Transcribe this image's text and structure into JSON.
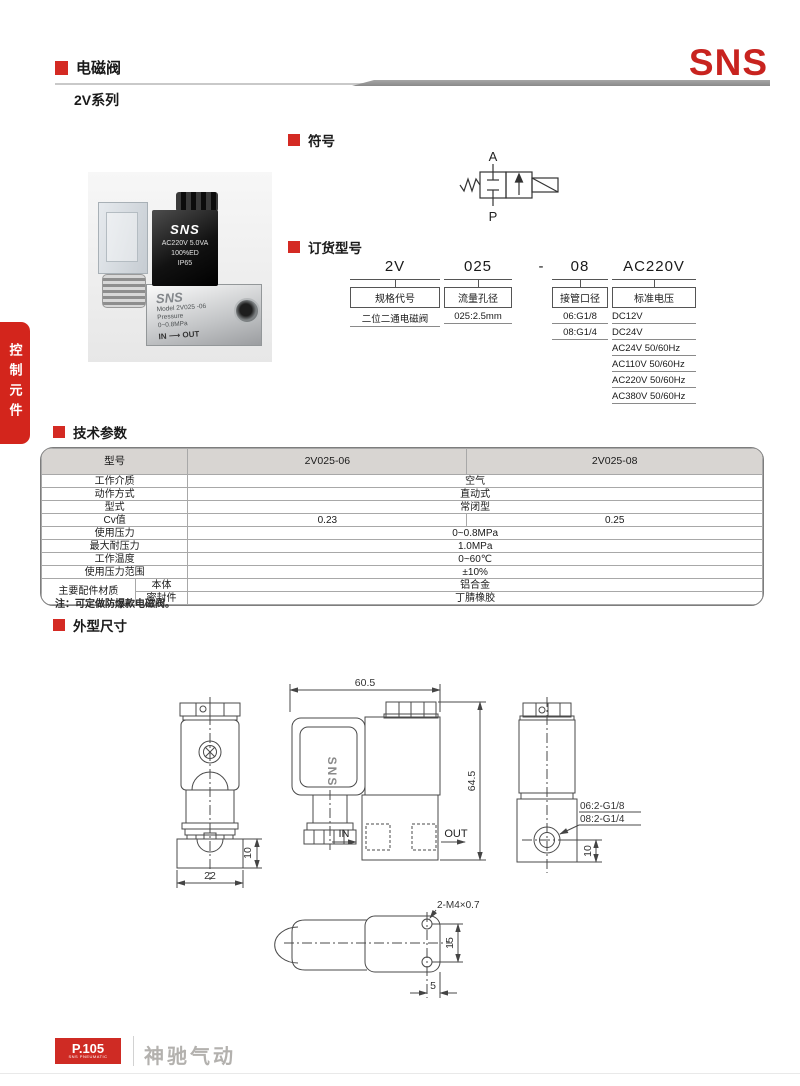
{
  "header": {
    "category_title": "电磁阀",
    "series_title": "2V系列",
    "brand_logo": "SNS"
  },
  "sidebar": {
    "tab_label": "控制元件"
  },
  "colors": {
    "brand_red": "#c8231f",
    "section_red": "#d42a23",
    "table_header_bg": "#d8d5d2"
  },
  "photo": {
    "coil_brand": "SNS",
    "coil_spec": "AC220V 5.0VA",
    "coil_duty": "100%ED",
    "coil_ip": "IP65",
    "body_brand": "SNS",
    "body_model": "Model 2V025 -06",
    "body_pressure_label": "Pressure",
    "body_pressure": "0~0.8MPa",
    "body_flow": "IN ⟶ OUT"
  },
  "sections": {
    "symbol": "符号",
    "ordering": "订货型号",
    "specs": "技术参数",
    "dimensions": "外型尺寸"
  },
  "symbol": {
    "port_top": "A",
    "port_bottom": "P"
  },
  "ordering": {
    "columns": [
      {
        "code": "2V",
        "label": "规格代号",
        "options": [
          "二位二通电磁阀"
        ]
      },
      {
        "code": "025",
        "label": "流量孔径",
        "options": [
          "025:2.5mm"
        ]
      },
      {
        "code": "-"
      },
      {
        "code": "08",
        "label": "接管口径",
        "options": [
          "06:G1/8",
          "08:G1/4"
        ]
      },
      {
        "code": "AC220V",
        "label": "标准电压",
        "options": [
          "DC12V",
          "DC24V",
          "AC24V 50/60Hz",
          "AC110V 50/60Hz",
          "AC220V 50/60Hz",
          "AC380V 50/60Hz"
        ]
      }
    ]
  },
  "specs": {
    "header": [
      "型号",
      "2V025-06",
      "2V025-08"
    ],
    "rows": {
      "medium": {
        "label": "工作介质",
        "value": "空气"
      },
      "action": {
        "label": "动作方式",
        "value": "直动式"
      },
      "type": {
        "label": "型式",
        "value": "常闭型"
      },
      "cv": {
        "label": "Cv值",
        "v06": "0.23",
        "v08": "0.25"
      },
      "pressure": {
        "label": "使用压力",
        "value": "0~0.8MPa"
      },
      "max_pressure": {
        "label": "最大耐压力",
        "value": "1.0MPa"
      },
      "temperature": {
        "label": "工作温度",
        "value": "0~60℃"
      },
      "range": {
        "label": "使用压力范围",
        "value": "±10%"
      },
      "materials": {
        "label": "主要配件材质",
        "body": {
          "label": "本体",
          "value": "铝合金"
        },
        "seal": {
          "label": "密封件",
          "value": "丁腈橡胶"
        }
      }
    },
    "note": "注：可定做防爆款电磁阀。"
  },
  "dims": {
    "front": {
      "width": "22",
      "base_height": "10"
    },
    "side": {
      "width": "60.5",
      "height": "64.5",
      "in_label": "IN",
      "out_label": "OUT",
      "brand": "SNS"
    },
    "rear": {
      "port_g18": "06:2-G1/8",
      "port_g14": "08:2-G1/4",
      "offset": "10"
    },
    "bottom": {
      "thread": "2-M4×0.7",
      "hole_pitch": "15",
      "edge_offset": "5"
    }
  },
  "footer": {
    "page_no": "P.105",
    "page_sub": "SNS PNEUMATIC",
    "company": "神驰气动"
  }
}
